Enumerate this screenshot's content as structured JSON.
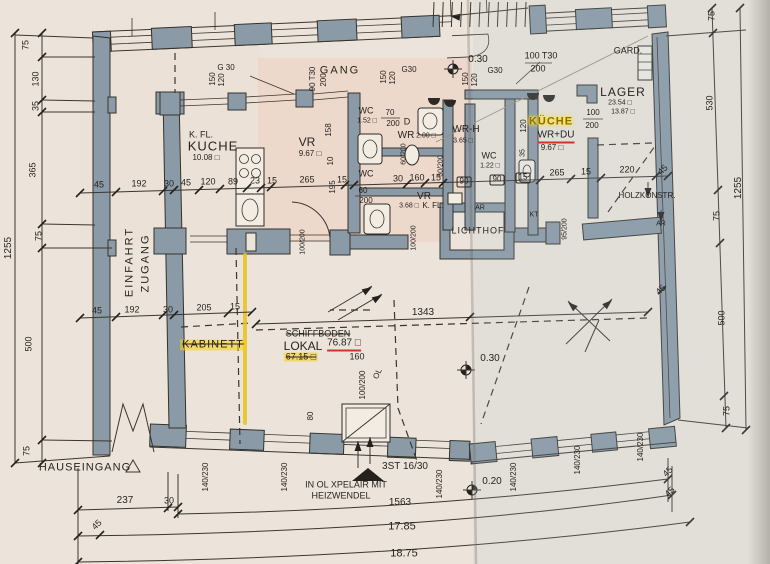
{
  "colors": {
    "highlight_yellow": "#e8c418",
    "annotation_red": "#c9362a",
    "wall_fill": "#8a9aa6",
    "paper_warm": "#ece4da",
    "paper_cool": "#e9edf0",
    "ink": "#35322c"
  },
  "labels": [
    {
      "t": "75",
      "x": 26,
      "y": 45,
      "r": -90
    },
    {
      "t": "130",
      "x": 36,
      "y": 79,
      "r": -90
    },
    {
      "t": "35",
      "x": 36,
      "y": 106,
      "r": -90
    },
    {
      "t": "365",
      "x": 33,
      "y": 170,
      "r": -90
    },
    {
      "t": "75",
      "x": 39,
      "y": 236,
      "r": -90
    },
    {
      "t": "1255",
      "x": 9,
      "y": 248,
      "r": -90,
      "s": 10
    },
    {
      "t": "500",
      "x": 29,
      "y": 344,
      "r": -90
    },
    {
      "t": "75",
      "x": 27,
      "y": 451,
      "r": -90
    },
    {
      "t": "75",
      "x": 712,
      "y": 16,
      "r": -90
    },
    {
      "t": "530",
      "x": 710,
      "y": 103,
      "r": -90
    },
    {
      "t": "75",
      "x": 717,
      "y": 216,
      "r": -90
    },
    {
      "t": "500",
      "x": 722,
      "y": 318,
      "r": -90
    },
    {
      "t": "75",
      "x": 727,
      "y": 411,
      "r": -90
    },
    {
      "t": "1255",
      "x": 739,
      "y": 188,
      "r": -90,
      "s": 10
    },
    {
      "t": "G 30",
      "x": 226,
      "y": 68,
      "s": 8
    },
    {
      "t": "150",
      "x": 213,
      "y": 79,
      "r": -90,
      "s": 8
    },
    {
      "t": "120",
      "x": 222,
      "y": 80,
      "r": -90,
      "s": 8
    },
    {
      "t": "GANG",
      "x": 340,
      "y": 71,
      "s": 11,
      "ls": 2
    },
    {
      "t": "90 T30",
      "x": 313,
      "y": 79,
      "r": -90,
      "s": 8
    },
    {
      "t": "200",
      "x": 324,
      "y": 80,
      "r": -90,
      "s": 8
    },
    {
      "t": "150",
      "x": 384,
      "y": 77,
      "r": -90,
      "s": 8
    },
    {
      "t": "120",
      "x": 393,
      "y": 78,
      "r": -90,
      "s": 8
    },
    {
      "t": "G30",
      "x": 409,
      "y": 70,
      "s": 8
    },
    {
      "t": "0.30",
      "x": 478,
      "y": 60,
      "s": 10
    },
    {
      "t": "150",
      "x": 466,
      "y": 79,
      "r": -90,
      "s": 8
    },
    {
      "t": "120",
      "x": 475,
      "y": 80,
      "r": -90,
      "s": 8
    },
    {
      "t": "G30",
      "x": 495,
      "y": 71,
      "s": 8
    },
    {
      "t": "100 T30",
      "x": 541,
      "y": 56,
      "s": 9
    },
    {
      "t": "200",
      "x": 538,
      "y": 69,
      "s": 9
    },
    {
      "t": "GARD.",
      "x": 628,
      "y": 51,
      "s": 9
    },
    {
      "t": "K. FL.",
      "x": 201,
      "y": 135,
      "s": 9
    },
    {
      "t": "KUCHE",
      "x": 213,
      "y": 146,
      "s": 13,
      "ls": 1
    },
    {
      "t": "10.08 □",
      "x": 206,
      "y": 158,
      "s": 8
    },
    {
      "t": "VR",
      "x": 307,
      "y": 142,
      "s": 12
    },
    {
      "t": "9.67 □",
      "x": 310,
      "y": 154,
      "s": 8
    },
    {
      "t": "WC",
      "x": 366,
      "y": 111,
      "s": 9
    },
    {
      "t": "1.52 □",
      "x": 367,
      "y": 121,
      "s": 7
    },
    {
      "t": "70",
      "x": 390,
      "y": 113,
      "s": 8
    },
    {
      "t": "200",
      "x": 393,
      "y": 124,
      "s": 8
    },
    {
      "t": "D",
      "x": 407,
      "y": 122,
      "s": 9
    },
    {
      "t": "WR",
      "x": 406,
      "y": 136,
      "s": 10
    },
    {
      "t": "2.00 □",
      "x": 426,
      "y": 136,
      "s": 7
    },
    {
      "t": "158",
      "x": 329,
      "y": 130,
      "r": -90,
      "s": 8
    },
    {
      "t": "10",
      "x": 331,
      "y": 161,
      "r": -90,
      "s": 8
    },
    {
      "t": "60/200",
      "x": 404,
      "y": 154,
      "r": -90,
      "s": 7
    },
    {
      "t": "60/200",
      "x": 441,
      "y": 166,
      "r": -90,
      "s": 7
    },
    {
      "t": "WC",
      "x": 366,
      "y": 174,
      "s": 9
    },
    {
      "t": "WR-H",
      "x": 466,
      "y": 130,
      "s": 10
    },
    {
      "t": "3.65 □",
      "x": 463,
      "y": 141,
      "s": 7
    },
    {
      "t": "WC",
      "x": 489,
      "y": 156,
      "s": 9
    },
    {
      "t": "1.22 □",
      "x": 490,
      "y": 166,
      "s": 7
    },
    {
      "t": "VR",
      "x": 424,
      "y": 197,
      "s": 10
    },
    {
      "t": "3.68 □",
      "x": 409,
      "y": 206,
      "s": 7
    },
    {
      "t": "K. FL.",
      "x": 433,
      "y": 206,
      "s": 8
    },
    {
      "t": "60",
      "x": 363,
      "y": 191,
      "s": 8
    },
    {
      "t": "200",
      "x": 366,
      "y": 201,
      "s": 8
    },
    {
      "t": "100/200",
      "x": 303,
      "y": 242,
      "r": -90,
      "s": 7
    },
    {
      "t": "100/200",
      "x": 414,
      "y": 238,
      "r": -90,
      "s": 7
    },
    {
      "t": "AR",
      "x": 480,
      "y": 208,
      "s": 7
    },
    {
      "t": "KT",
      "x": 534,
      "y": 215,
      "s": 7
    },
    {
      "t": "LICHTHOF",
      "x": 478,
      "y": 231,
      "s": 9,
      "ls": 1
    },
    {
      "t": "95/200",
      "x": 565,
      "y": 229,
      "r": -90,
      "s": 7
    },
    {
      "t": "KÜCHE",
      "x": 551,
      "y": 122,
      "s": 11,
      "c": "yellow",
      "ls": 1
    },
    {
      "t": "WR+DU",
      "x": 556,
      "y": 137,
      "s": 10,
      "c": "redline"
    },
    {
      "t": "9.67 □",
      "x": 552,
      "y": 148,
      "s": 8
    },
    {
      "t": "120",
      "x": 524,
      "y": 126,
      "r": -90,
      "s": 8
    },
    {
      "t": "35",
      "x": 523,
      "y": 153,
      "r": -90,
      "s": 7
    },
    {
      "t": "LAGER",
      "x": 623,
      "y": 92,
      "s": 12,
      "ls": 1
    },
    {
      "t": "23.54 □",
      "x": 620,
      "y": 103,
      "s": 7
    },
    {
      "t": "13.87 □",
      "x": 623,
      "y": 112,
      "s": 7
    },
    {
      "t": "100",
      "x": 593,
      "y": 113,
      "s": 8
    },
    {
      "t": "200",
      "x": 592,
      "y": 126,
      "s": 8
    },
    {
      "t": "HOLZKONSTR.",
      "x": 647,
      "y": 196,
      "s": 8
    },
    {
      "t": "AR",
      "x": 661,
      "y": 224,
      "s": 7
    },
    {
      "t": "EINFAHRT",
      "x": 130,
      "y": 262,
      "r": -90,
      "s": 11,
      "ls": 2
    },
    {
      "t": "ZUGANG",
      "x": 146,
      "y": 263,
      "r": -90,
      "s": 11,
      "ls": 2
    },
    {
      "t": "45",
      "x": 99,
      "y": 185
    },
    {
      "t": "192",
      "x": 139,
      "y": 184
    },
    {
      "t": "30",
      "x": 169,
      "y": 184
    },
    {
      "t": "45",
      "x": 186,
      "y": 183
    },
    {
      "t": "120",
      "x": 208,
      "y": 182
    },
    {
      "t": "89",
      "x": 233,
      "y": 182
    },
    {
      "t": "23",
      "x": 255,
      "y": 181
    },
    {
      "t": "15",
      "x": 272,
      "y": 181
    },
    {
      "t": "265",
      "x": 307,
      "y": 180
    },
    {
      "t": "195",
      "x": 333,
      "y": 187,
      "r": -90,
      "s": 8
    },
    {
      "t": "15",
      "x": 342,
      "y": 180
    },
    {
      "t": "30",
      "x": 398,
      "y": 179
    },
    {
      "t": "160",
      "x": 417,
      "y": 178
    },
    {
      "t": "15",
      "x": 436,
      "y": 178
    },
    {
      "t": "90",
      "x": 464,
      "y": 182,
      "c": "boxed",
      "s": 8
    },
    {
      "t": "90",
      "x": 497,
      "y": 180,
      "c": "boxed",
      "s": 8
    },
    {
      "t": "15",
      "x": 523,
      "y": 178,
      "c": "boxed",
      "s": 8
    },
    {
      "t": "265",
      "x": 557,
      "y": 173
    },
    {
      "t": "15",
      "x": 586,
      "y": 172
    },
    {
      "t": "220",
      "x": 627,
      "y": 170
    },
    {
      "t": "45",
      "x": 663,
      "y": 170,
      "r": -45
    },
    {
      "t": "45",
      "x": 97,
      "y": 311
    },
    {
      "t": "192",
      "x": 132,
      "y": 310
    },
    {
      "t": "30",
      "x": 168,
      "y": 310
    },
    {
      "t": "205",
      "x": 204,
      "y": 308
    },
    {
      "t": "15",
      "x": 235,
      "y": 307
    },
    {
      "t": "1343",
      "x": 423,
      "y": 313,
      "s": 10
    },
    {
      "t": "KABINETT",
      "x": 213,
      "y": 345,
      "s": 11,
      "c": "yellowstrike",
      "ls": 1
    },
    {
      "t": "SCHIFFBODEN",
      "x": 318,
      "y": 334,
      "s": 9,
      "c": "strike"
    },
    {
      "t": "LOKAL",
      "x": 303,
      "y": 346,
      "s": 12
    },
    {
      "t": "76.87 □",
      "x": 344,
      "y": 345,
      "s": 10,
      "c": "redline"
    },
    {
      "t": "67.15 □",
      "x": 301,
      "y": 357,
      "s": 9,
      "c": "yellowstrike"
    },
    {
      "t": "160",
      "x": 357,
      "y": 357,
      "s": 9
    },
    {
      "t": "100/200",
      "x": 363,
      "y": 385,
      "r": -90,
      "s": 8
    },
    {
      "t": "OL",
      "x": 378,
      "y": 374,
      "r": -65,
      "s": 8
    },
    {
      "t": "80",
      "x": 311,
      "y": 416,
      "r": -90,
      "s": 8
    },
    {
      "t": "0.30",
      "x": 490,
      "y": 359,
      "s": 10
    },
    {
      "t": "0.20",
      "x": 492,
      "y": 482,
      "s": 10
    },
    {
      "t": "HAUSEINGANG",
      "x": 85,
      "y": 468,
      "s": 11,
      "ls": 1
    },
    {
      "t": "3ST 16/30",
      "x": 405,
      "y": 467,
      "s": 10
    },
    {
      "t": "IN OL XPELAIR MIT",
      "x": 346,
      "y": 485,
      "s": 9
    },
    {
      "t": "HEIZWENDEL",
      "x": 341,
      "y": 496,
      "s": 9
    },
    {
      "t": "140/230",
      "x": 206,
      "y": 477,
      "r": -90,
      "s": 8
    },
    {
      "t": "140/230",
      "x": 285,
      "y": 477,
      "r": -90,
      "s": 8
    },
    {
      "t": "140/230",
      "x": 440,
      "y": 484,
      "r": -90,
      "s": 8
    },
    {
      "t": "140/230",
      "x": 514,
      "y": 477,
      "r": -90,
      "s": 8
    },
    {
      "t": "140/230",
      "x": 578,
      "y": 460,
      "r": -90,
      "s": 8
    },
    {
      "t": "140/230",
      "x": 641,
      "y": 447,
      "r": -90,
      "s": 8
    },
    {
      "t": "237",
      "x": 125,
      "y": 501,
      "s": 10
    },
    {
      "t": "30",
      "x": 169,
      "y": 501,
      "s": 9
    },
    {
      "t": "45",
      "x": 97,
      "y": 525,
      "r": -45
    },
    {
      "t": "1563",
      "x": 400,
      "y": 503,
      "s": 10
    },
    {
      "t": "17.85",
      "x": 402,
      "y": 527,
      "s": 11
    },
    {
      "t": "18.75",
      "x": 404,
      "y": 554,
      "s": 11
    },
    {
      "t": "45",
      "x": 668,
      "y": 472,
      "r": -45
    },
    {
      "t": "45",
      "x": 670,
      "y": 492,
      "r": -45
    },
    {
      "t": "45",
      "x": 661,
      "y": 290,
      "r": -45
    }
  ]
}
